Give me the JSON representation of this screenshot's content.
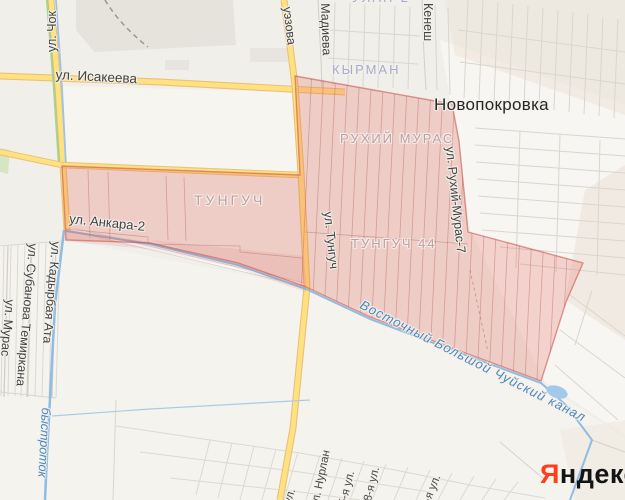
{
  "labels": {
    "town": "Новопокровка",
    "districts": {
      "kyrman": "КЫРМАН",
      "ruhij_muras": "РУХИЙ МУРАС",
      "tunguch": "ТУНГУЧ",
      "tunguch_44": "ТУНГУЧ 44",
      "ulan_2": "УЛАН-2"
    },
    "streets": {
      "isakeeva": "ул. Исакеева",
      "chok": "ул. Чок",
      "auezova": "уэзова",
      "madieva": "Мадиева",
      "kenesh": "Кенеш",
      "ankara_2": "ул. Анкара-2",
      "tunguch": "ул. Тунгуч",
      "ruhij_muras_7": "ул. Рухий-Мурас-7",
      "muras": "ул. Мурас",
      "subanova_temirkana": "ул. Субанова Темиркана",
      "kadyrbaj_ata": "ул. Кадырбая Ата",
      "nurlan": "ул. Нурлан",
      "s5": "5-я ул.",
      "s8": "8-я ул.",
      "s9": "9-я ул.",
      "partial": "ул."
    },
    "water": {
      "canal": "Восточный Большой Чуйский канал",
      "bystrotok": "быстроток"
    }
  },
  "logo": {
    "first": "Я",
    "rest": "ндекс"
  },
  "colors": {
    "background": "#f1efea",
    "highlight_fill": "rgba(232,96,86,0.24)",
    "highlight_stroke": "rgba(198,74,66,0.55)",
    "major_road": "#ffe182",
    "water": "#8fbce2",
    "logo_accent": "#fc3f1d",
    "district_text_pink": "#c69ba1",
    "district_text_blue": "#a6abce"
  }
}
